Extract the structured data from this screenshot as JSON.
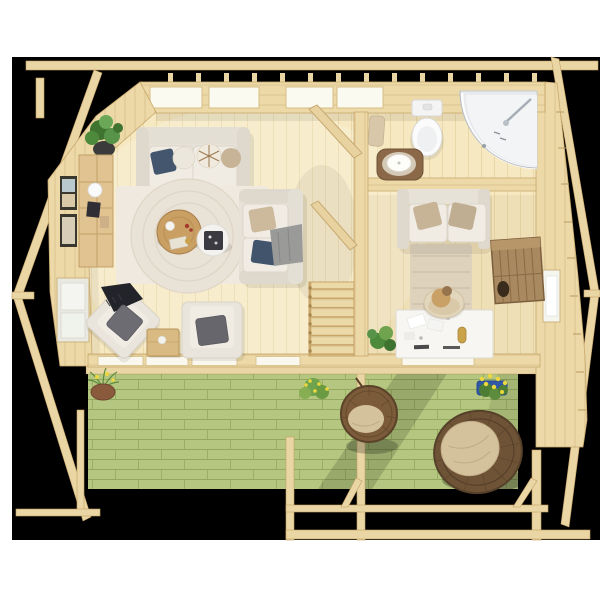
{
  "scene": {
    "type": "3d-floor-plan-render",
    "setting": "log cabin garden house viewed from directly above, black photo backdrop with white page margins, green-stained front deck with pergola",
    "rooms": [
      {
        "name": "living-room",
        "furniture": [
          "corner-plant",
          "wall-shelf",
          "picture-frame",
          "picture-frame",
          "left-wall-window",
          "three-seat-sofa",
          "loveseat-sofa",
          "area-rug",
          "round-coffee-table",
          "white-side-table",
          "accent-armchair-rotated",
          "accent-armchair",
          "wooden-side-table"
        ]
      },
      {
        "name": "stair-hall",
        "furniture": [
          "staircase",
          "stair-railing-upper",
          "stair-railing-lower"
        ]
      },
      {
        "name": "bathroom",
        "furniture": [
          "toilet",
          "corner-shower",
          "wash-basin-stand",
          "towel"
        ]
      },
      {
        "name": "home-office",
        "furniture": [
          "office-loveseat",
          "runner-rug",
          "desk",
          "desk-chair",
          "person",
          "rustic-cabinet",
          "potted-plant",
          "right-wall-window"
        ]
      },
      {
        "name": "deck",
        "furniture": [
          "hanging-egg-chair",
          "papasan-chair",
          "terracotta-planter",
          "yellow-flower-bush",
          "blue-flower-box",
          "pergola-posts",
          "pergola-beams"
        ]
      }
    ]
  },
  "colors": {
    "page_bg": "#ffffff",
    "backdrop_black": "#000000",
    "wood_wall": "#ecd9a7",
    "wall_edge": "#c9a96e",
    "wall_grain": "rgba(163,122,62,0.22)",
    "wood_floor": "#f6e8c0",
    "floor_line": "#e5d09e",
    "wood_beam": "#e9d6a4",
    "beam_edge": "#c3a066",
    "deck_green": "#b4c67f",
    "deck_line": "#93a85e",
    "skylight": "#fbfaf0",
    "window_white": "#f6f6f0",
    "sofa_cream": "#e7e2d8",
    "sofa_arm": "#dfd9cd",
    "cushion_light": "#f0ece4",
    "cushion_line": "#dbd5c9",
    "pillow_navy": "#44566e",
    "pillow_navy2": "#42546c",
    "pillow_beige": "#c7b396",
    "pillow_gray": "#6c6c72",
    "throw_dark": "#23232a",
    "throw_gray": "#9a9a98",
    "rug_light": "#efe9df",
    "rug_ring": "#ded5c6",
    "rug_runner": "#ded2bc",
    "table_wood": "#c99f63",
    "table_wood_edge": "#a87f4a",
    "table_white": "#f3f2ee",
    "tray_dark": "#3a3a40",
    "fixture_white": "#fbfbfb",
    "fixture_edge": "#d9d9d9",
    "shower_glass": "#e8eaed",
    "shower_tray": "#f3f4f6",
    "vanity_brown": "#8a6848",
    "wardrobe_wood": "#a9895f",
    "wardrobe_line": "#7c5f3e",
    "rattan": "#7b5b3a",
    "rattan_dark": "#5a4229",
    "papasan": "#6f5336",
    "cushion_beige": "#d4c29c",
    "plant_green": "#4e8a3c",
    "plant_light": "#6fa34e",
    "flower_yellow": "#ecd83e",
    "pot_blue": "#3059a8",
    "pot_terracotta": "#8a5a3c",
    "pot_dark": "#3b3b3b",
    "desk_white": "#f7f6f2",
    "skin_tan": "#c9a066",
    "hair_brown": "#96744e",
    "gold": "#c9a24a"
  }
}
